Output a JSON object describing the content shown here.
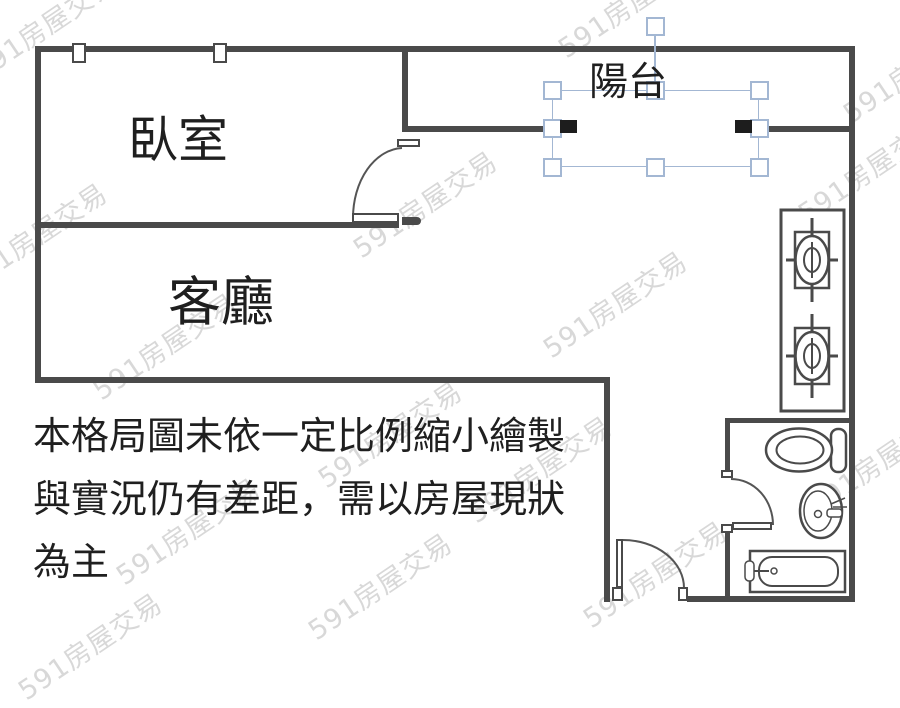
{
  "floorplan": {
    "rooms": {
      "bedroom": {
        "label": "臥室"
      },
      "living": {
        "label": "客廳"
      },
      "balcony": {
        "label": "陽台"
      }
    },
    "disclaimer": {
      "lines": [
        "本格局圖未依一定比例縮小繪製",
        "與實況仍有差距，需以房屋現狀",
        "為主"
      ]
    },
    "watermark": {
      "text": "591房屋交易"
    },
    "fixtures": [
      "stove-2-burner",
      "toilet",
      "sink",
      "bathtub"
    ],
    "doors": [
      "bedroom-door",
      "entry-door",
      "bathroom-door"
    ],
    "windows_count": 2,
    "selection": {
      "selected_label": "陽台",
      "handles": 8,
      "has_rotation_handle": true
    },
    "colors": {
      "wall": "#4a4a4a",
      "cap": "#1d1d1d",
      "selection": "#a3b7d3",
      "ink": "#1f1f1f",
      "watermark": "#d8d8d8"
    }
  }
}
